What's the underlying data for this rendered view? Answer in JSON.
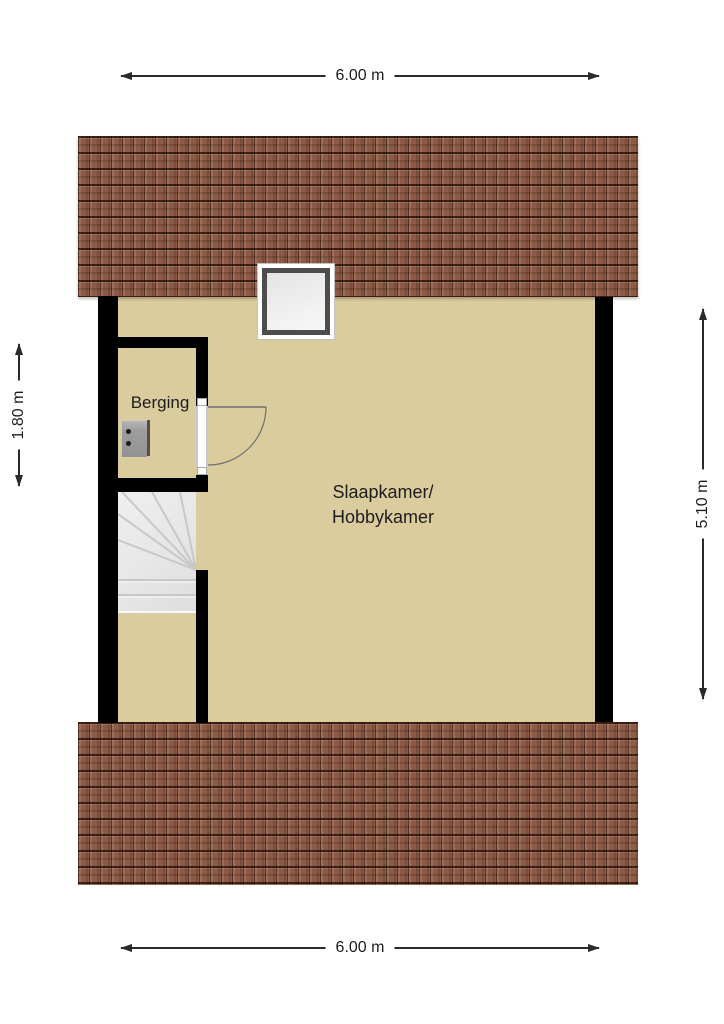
{
  "labels": {
    "berging": "Berging",
    "main_room_line1": "Slaapkamer/",
    "main_room_line2": "Hobbykamer"
  },
  "dimensions": {
    "top": "6.00 m",
    "bottom": "6.00 m",
    "left": "1.80 m",
    "right": "5.10 m"
  },
  "icons": {
    "skylight": "skylight-window",
    "door": "door-swing",
    "stairs": "winder-staircase",
    "appliance": "boiler-unit"
  },
  "colors": {
    "floor": "#dacc9c",
    "roof-base": "#8d5a45",
    "wall": "#000000",
    "stairs-fill": "#e6e6e6",
    "stair-line": "#c8c8c8",
    "dim-line": "#2a2a2a",
    "text": "#1d1d1f",
    "door-line": "#6e6e6e",
    "skylight-frame": "#4d4d4d",
    "appliance-gray": "#9c9c9c"
  }
}
